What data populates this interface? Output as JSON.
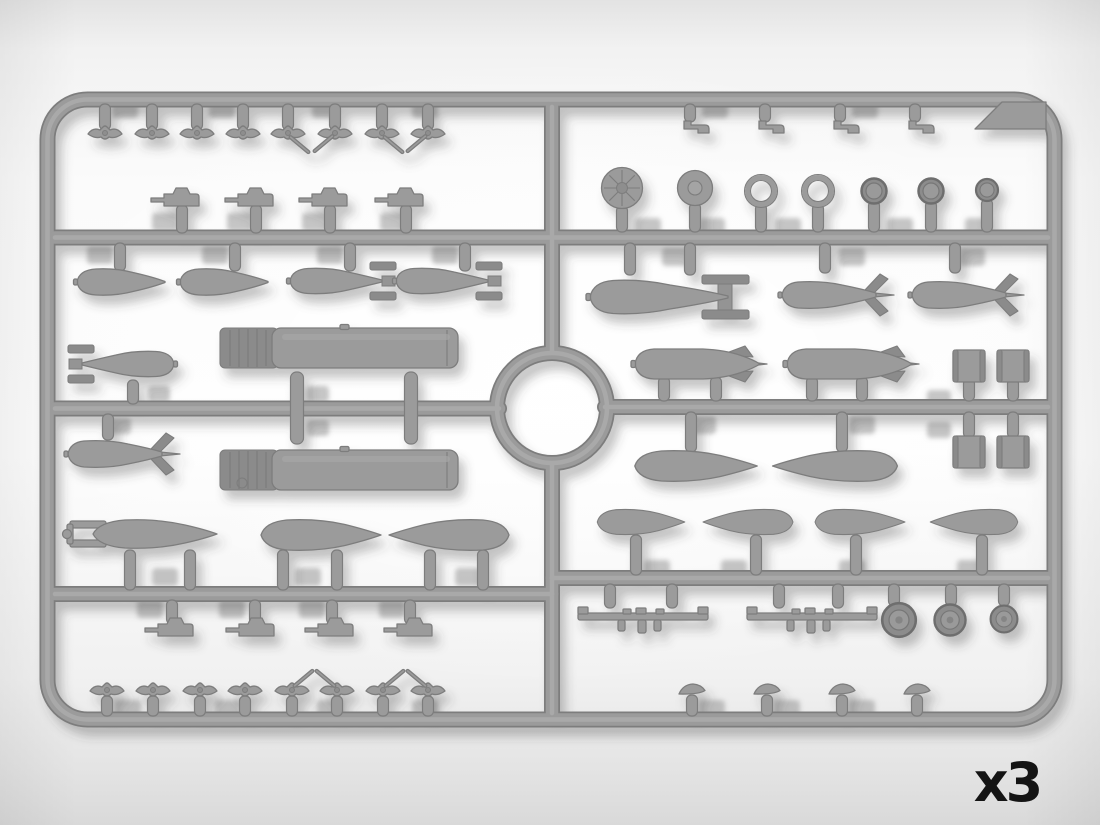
{
  "scene": {
    "type": "product-render",
    "subject": "Injection-molded plastic model sprue with aircraft armament parts (bombs, drop tanks, torpedo, gun pods, wheels, bomb racks, fuzes)",
    "quantity_label": "x3",
    "colors": {
      "bg_top": "#e3e3e3",
      "bg_center": "#fdfdfd",
      "bg_bottom": "#d9d9d9",
      "sprue": "#9b9b9b",
      "sprue_edge": "#7d7d7d",
      "sprue_light": "#acacac",
      "sprue_dark": "#8b8b8b",
      "ghost_shadow": "#979797",
      "label_text": "#141414"
    },
    "layout": {
      "frame": "rounded rectangle runner frame",
      "center_feature": "circular ring runner at sprue center",
      "corner_tab": "solid tab in top-right corner"
    },
    "part_groups": [
      {
        "name": "bomb fuzes with arming vanes",
        "count": 8,
        "location": "top-left row"
      },
      {
        "name": "gun pods",
        "count": 4,
        "location": "upper-left row"
      },
      {
        "name": "plain bomb halves",
        "count": 2,
        "location": "left third row"
      },
      {
        "name": "box-fin bombs",
        "count": 2,
        "location": "left third row"
      },
      {
        "name": "box-fin bomb (fins left)",
        "count": 1,
        "location": "left middle"
      },
      {
        "name": "cruciform-fin bomb",
        "count": 1,
        "location": "left middle"
      },
      {
        "name": "large pod / tank bodies with ribbed front",
        "count": 2,
        "location": "left center"
      },
      {
        "name": "torpedo with tail prongs",
        "count": 1,
        "location": "lower left"
      },
      {
        "name": "drop-tank halves",
        "count": 2,
        "location": "lower left"
      },
      {
        "name": "gun pods",
        "count": 4,
        "location": "lower-left row"
      },
      {
        "name": "bomb fuzes with arming vanes",
        "count": 8,
        "location": "bottom-left row"
      },
      {
        "name": "small brackets",
        "count": 4,
        "location": "top-right row"
      },
      {
        "name": "ribbed spinner disc",
        "count": 1,
        "location": "right discs row"
      },
      {
        "name": "hub disc",
        "count": 1,
        "location": "right discs row"
      },
      {
        "name": "open rings",
        "count": 2,
        "location": "right discs row"
      },
      {
        "name": "small wheel discs",
        "count": 3,
        "location": "right discs row"
      },
      {
        "name": "large box-fin bomb",
        "count": 1,
        "location": "right second row"
      },
      {
        "name": "cruciform-fin bombs",
        "count": 2,
        "location": "right second row"
      },
      {
        "name": "large finned bombs",
        "count": 2,
        "location": "right center"
      },
      {
        "name": "drum / cowl sections",
        "count": 4,
        "location": "right center pairs"
      },
      {
        "name": "drop-tank halves",
        "count": 2,
        "location": "right center"
      },
      {
        "name": "bomb halves",
        "count": 4,
        "location": "right lower row"
      },
      {
        "name": "bomb racks",
        "count": 2,
        "location": "bottom right"
      },
      {
        "name": "wheels",
        "count": 3,
        "location": "bottom right"
      },
      {
        "name": "small fairings",
        "count": 4,
        "location": "bottom-right row"
      }
    ]
  }
}
